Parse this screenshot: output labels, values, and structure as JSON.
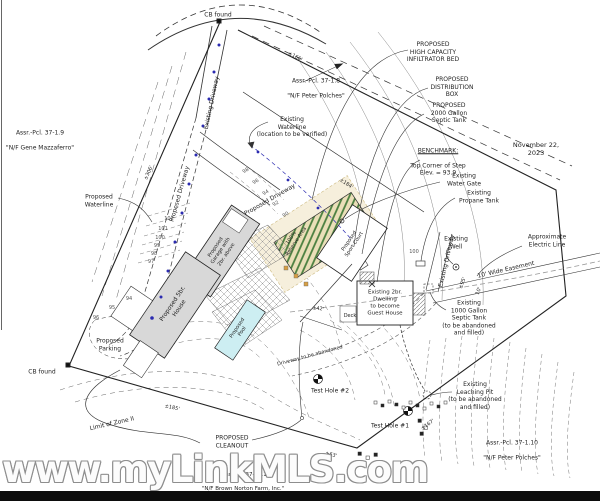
{
  "meta": {
    "date": "November 22, 2023"
  },
  "watermark": {
    "text": "www.myLinkMLS.com"
  },
  "colors": {
    "paper": "#ffffff",
    "ink": "#2b2b2b",
    "building_fill": "#d8d8d8",
    "pool_fill": "#cdeef2",
    "bed_stripe": "#4a7f3f",
    "bed_bg": "#eadfb8",
    "reserve_halo": "#f6efdc",
    "waterline_blue": "#2b2bb0",
    "watermark_outline": "#8e8e8e",
    "footer_bar": "#0c0c0c"
  },
  "parcels": {
    "p18": {
      "id": "Assr.-Pcl. 37-1.8",
      "owner": "\"N/F Peter Polches\""
    },
    "p19": {
      "id": "Assr.-Pcl. 37-1.9",
      "owner": "\"N/F Gene Mazzaferro\""
    },
    "p110": {
      "id": "Assr.-Pcl. 37-1.10",
      "owner": "\"N/F Peter Polches\""
    },
    "p111": {
      "id": "Assr.-Pcl. 37-1.11",
      "owner": "\"N/F Brown Norton Farm, Inc.\""
    }
  },
  "callouts": {
    "infiltrator": "PROPOSED\nHIGH CAPACITY\nINFILTRATOR BED",
    "distribution_box": "PROPOSED\nDISTRIBUTION\nBOX",
    "septic_2000": "PROPOSED\n2000 Gallon\nSeptic Tank",
    "benchmark_title": "BENCHMARK:",
    "benchmark_body": "Top Corner of Step\nElev. = 93.9",
    "water_gate": "Existing\nWater Gate",
    "propane": "Existing\nPropane Tank",
    "well": "Existing\nWell",
    "electric": "Approximate\nElectric Line",
    "easement": "10' Wide Easement",
    "septic_1000": "Existing\n1000 Gallon\nSeptic Tank\n(to be abandoned\nand filled)",
    "leaching_pit": "Existing\nLeaching Pit\n(to be abandoned\nand filled)",
    "existing_waterline": "Existing\nWaterline\n(location to be verified)",
    "proposed_waterline": "Proposed\nWaterline",
    "cleanout": "PROPOSED\nCLEANOUT",
    "parking": "Proposed\nParking",
    "zone2": "Limit of Zone II",
    "cb_found_top": "CB found",
    "cb_found_left": "CB found",
    "test_hole_1": "Test Hole #1",
    "test_hole_2": "Test Hole #2",
    "deck": "Deck",
    "driveway_abandoned": "Driveway to be abandoned",
    "existing_driveway_top": "Existing Driveway",
    "existing_driveway_right": "Existing Driveway",
    "proposed_driveway_1": "Proposed Driveway",
    "proposed_driveway_2": "Proposed Driveway"
  },
  "buildings": {
    "house": "Proposed 5br.\nHouse",
    "garage": "Proposed\nGarage with\n2br. above",
    "pool": "Proposed\nPool",
    "sport_court": "Proposed\nSport Court",
    "guest_house": "Existing 2br.\nDwelling\nto become\nGuest House",
    "reserve_area": "100%\nReserve Area"
  },
  "dimensions": {
    "left": "±306'",
    "upper": "±184'",
    "top_right": "±166'",
    "easement_len": "±95'",
    "easement_w": "10'",
    "bottom_left": "±185'",
    "bottom": "±63'",
    "bottom_right": "±167'",
    "mid": "±42'"
  },
  "contour_labels": [
    "102",
    "101",
    "100",
    "99",
    "98",
    "97",
    "98",
    "96",
    "94",
    "92",
    "90",
    "100",
    "96",
    "95",
    "94"
  ]
}
